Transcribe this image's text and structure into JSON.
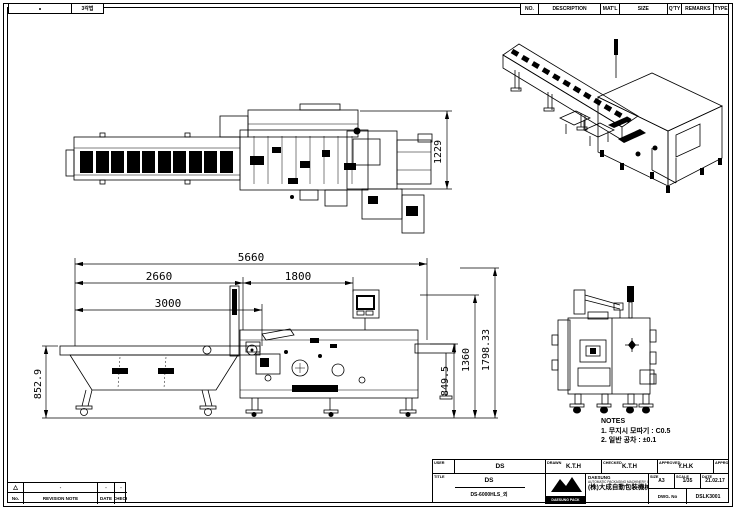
{
  "sheet": {
    "projection_label": "3각법",
    "line_color": "#000000",
    "bg_color": "#ffffff"
  },
  "parts_table": {
    "headers": [
      "NO.",
      "DESCRIPTION",
      "MAT'L",
      "SIZE",
      "Q'TY",
      "REMARKS",
      "TYPE"
    ]
  },
  "revision_table": {
    "headers": [
      "No.",
      "REVISION NOTE",
      "DATE",
      "CHECK"
    ],
    "row": [
      "△",
      "-",
      "-",
      "-"
    ]
  },
  "dimensions": {
    "plan_height": "1229",
    "overall_length": "5660",
    "infeed_length": "2660",
    "wrapper_length": "1800",
    "conveyor_length": "3000",
    "infeed_height": "852.9",
    "discharge_height": "849.5",
    "body_height": "1360",
    "max_height": "1798.33"
  },
  "notes": {
    "title": "NOTES",
    "lines": [
      "1. 무지시 모따기 : C0.5",
      "2. 일반 공차 : ±0.1"
    ]
  },
  "title_block": {
    "user_label": "USER",
    "user_value": "DS",
    "title_label": "TITLE",
    "title_value": "DS",
    "subtitle_value": "DS-6000HLS_외",
    "signatures": [
      {
        "label": "DRAWN",
        "value": "K.T.H"
      },
      {
        "label": "CHECKED",
        "value": "K.T.H"
      },
      {
        "label": "APPROVED",
        "value": "Y.H.K"
      },
      {
        "label": "APPROVED",
        "value": ""
      }
    ],
    "logo_text": "DAESUNG PACK",
    "company_name": "DAESUNG",
    "company_sub": "AUTOMATIC PACKAGING MACHINERY CO., LTD.",
    "company_cjk": "(株)大成自動包裝機械",
    "size_label": "SIZE",
    "size_value": "A3",
    "scale_label": "SCALE",
    "scale_value": "1/35",
    "date_label": "DATE",
    "date_value": "21.02.17",
    "dwg_label": "DWG. No",
    "dwg_value": "DSLK3001"
  }
}
